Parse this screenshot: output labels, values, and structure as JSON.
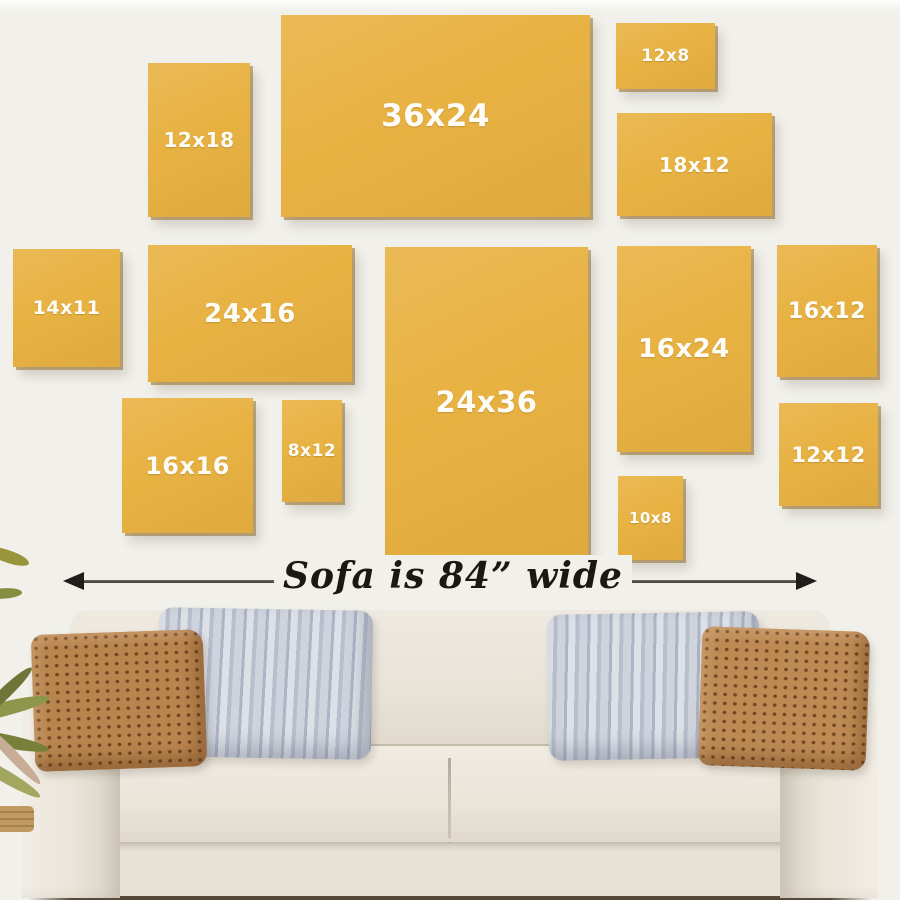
{
  "wall": {
    "background": "#f1f0ea",
    "canvas_color": "#e8b243",
    "canvas_label_color": "#fdfcf6"
  },
  "canvases": [
    {
      "label": "12x18",
      "box": [
        148,
        63,
        102,
        154
      ],
      "fs": 20
    },
    {
      "label": "36x24",
      "box": [
        281,
        15,
        309,
        202
      ],
      "fs": 31
    },
    {
      "label": "12x8",
      "box": [
        616,
        23,
        99,
        66
      ],
      "fs": 17
    },
    {
      "label": "18x12",
      "box": [
        617,
        113,
        155,
        103
      ],
      "fs": 20
    },
    {
      "label": "14x11",
      "box": [
        13,
        249,
        107,
        118
      ],
      "fs": 19
    },
    {
      "label": "24x16",
      "box": [
        148,
        245,
        204,
        137
      ],
      "fs": 26
    },
    {
      "label": "24x36",
      "box": [
        385,
        247,
        203,
        309
      ],
      "fs": 29
    },
    {
      "label": "16x24",
      "box": [
        617,
        246,
        134,
        206
      ],
      "fs": 26
    },
    {
      "label": "16x12",
      "box": [
        777,
        245,
        100,
        132
      ],
      "fs": 22
    },
    {
      "label": "16x16",
      "box": [
        122,
        398,
        131,
        135
      ],
      "fs": 24
    },
    {
      "label": "8x12",
      "box": [
        282,
        400,
        60,
        102
      ],
      "fs": 17
    },
    {
      "label": "10x8",
      "box": [
        618,
        476,
        65,
        84
      ],
      "fs": 15
    },
    {
      "label": "12x12",
      "box": [
        779,
        403,
        99,
        103
      ],
      "fs": 21
    }
  ],
  "measure": {
    "label": "Sofa is 84” wide",
    "line_color": "#4a4840",
    "arrowhead_color": "#201e1a",
    "text_color": "#1b1813"
  },
  "sofa": {
    "body_color": "#eae4da",
    "seat_color": "#efeae1",
    "base_color": "#e7e1d6",
    "pillow_brown": "#b9854f",
    "pillow_gray": "#cdd2db",
    "floor_shadow": "#3e2c1c"
  },
  "plant": {
    "leaf_color": "#8d974b",
    "pot_color": "#c09a62"
  }
}
